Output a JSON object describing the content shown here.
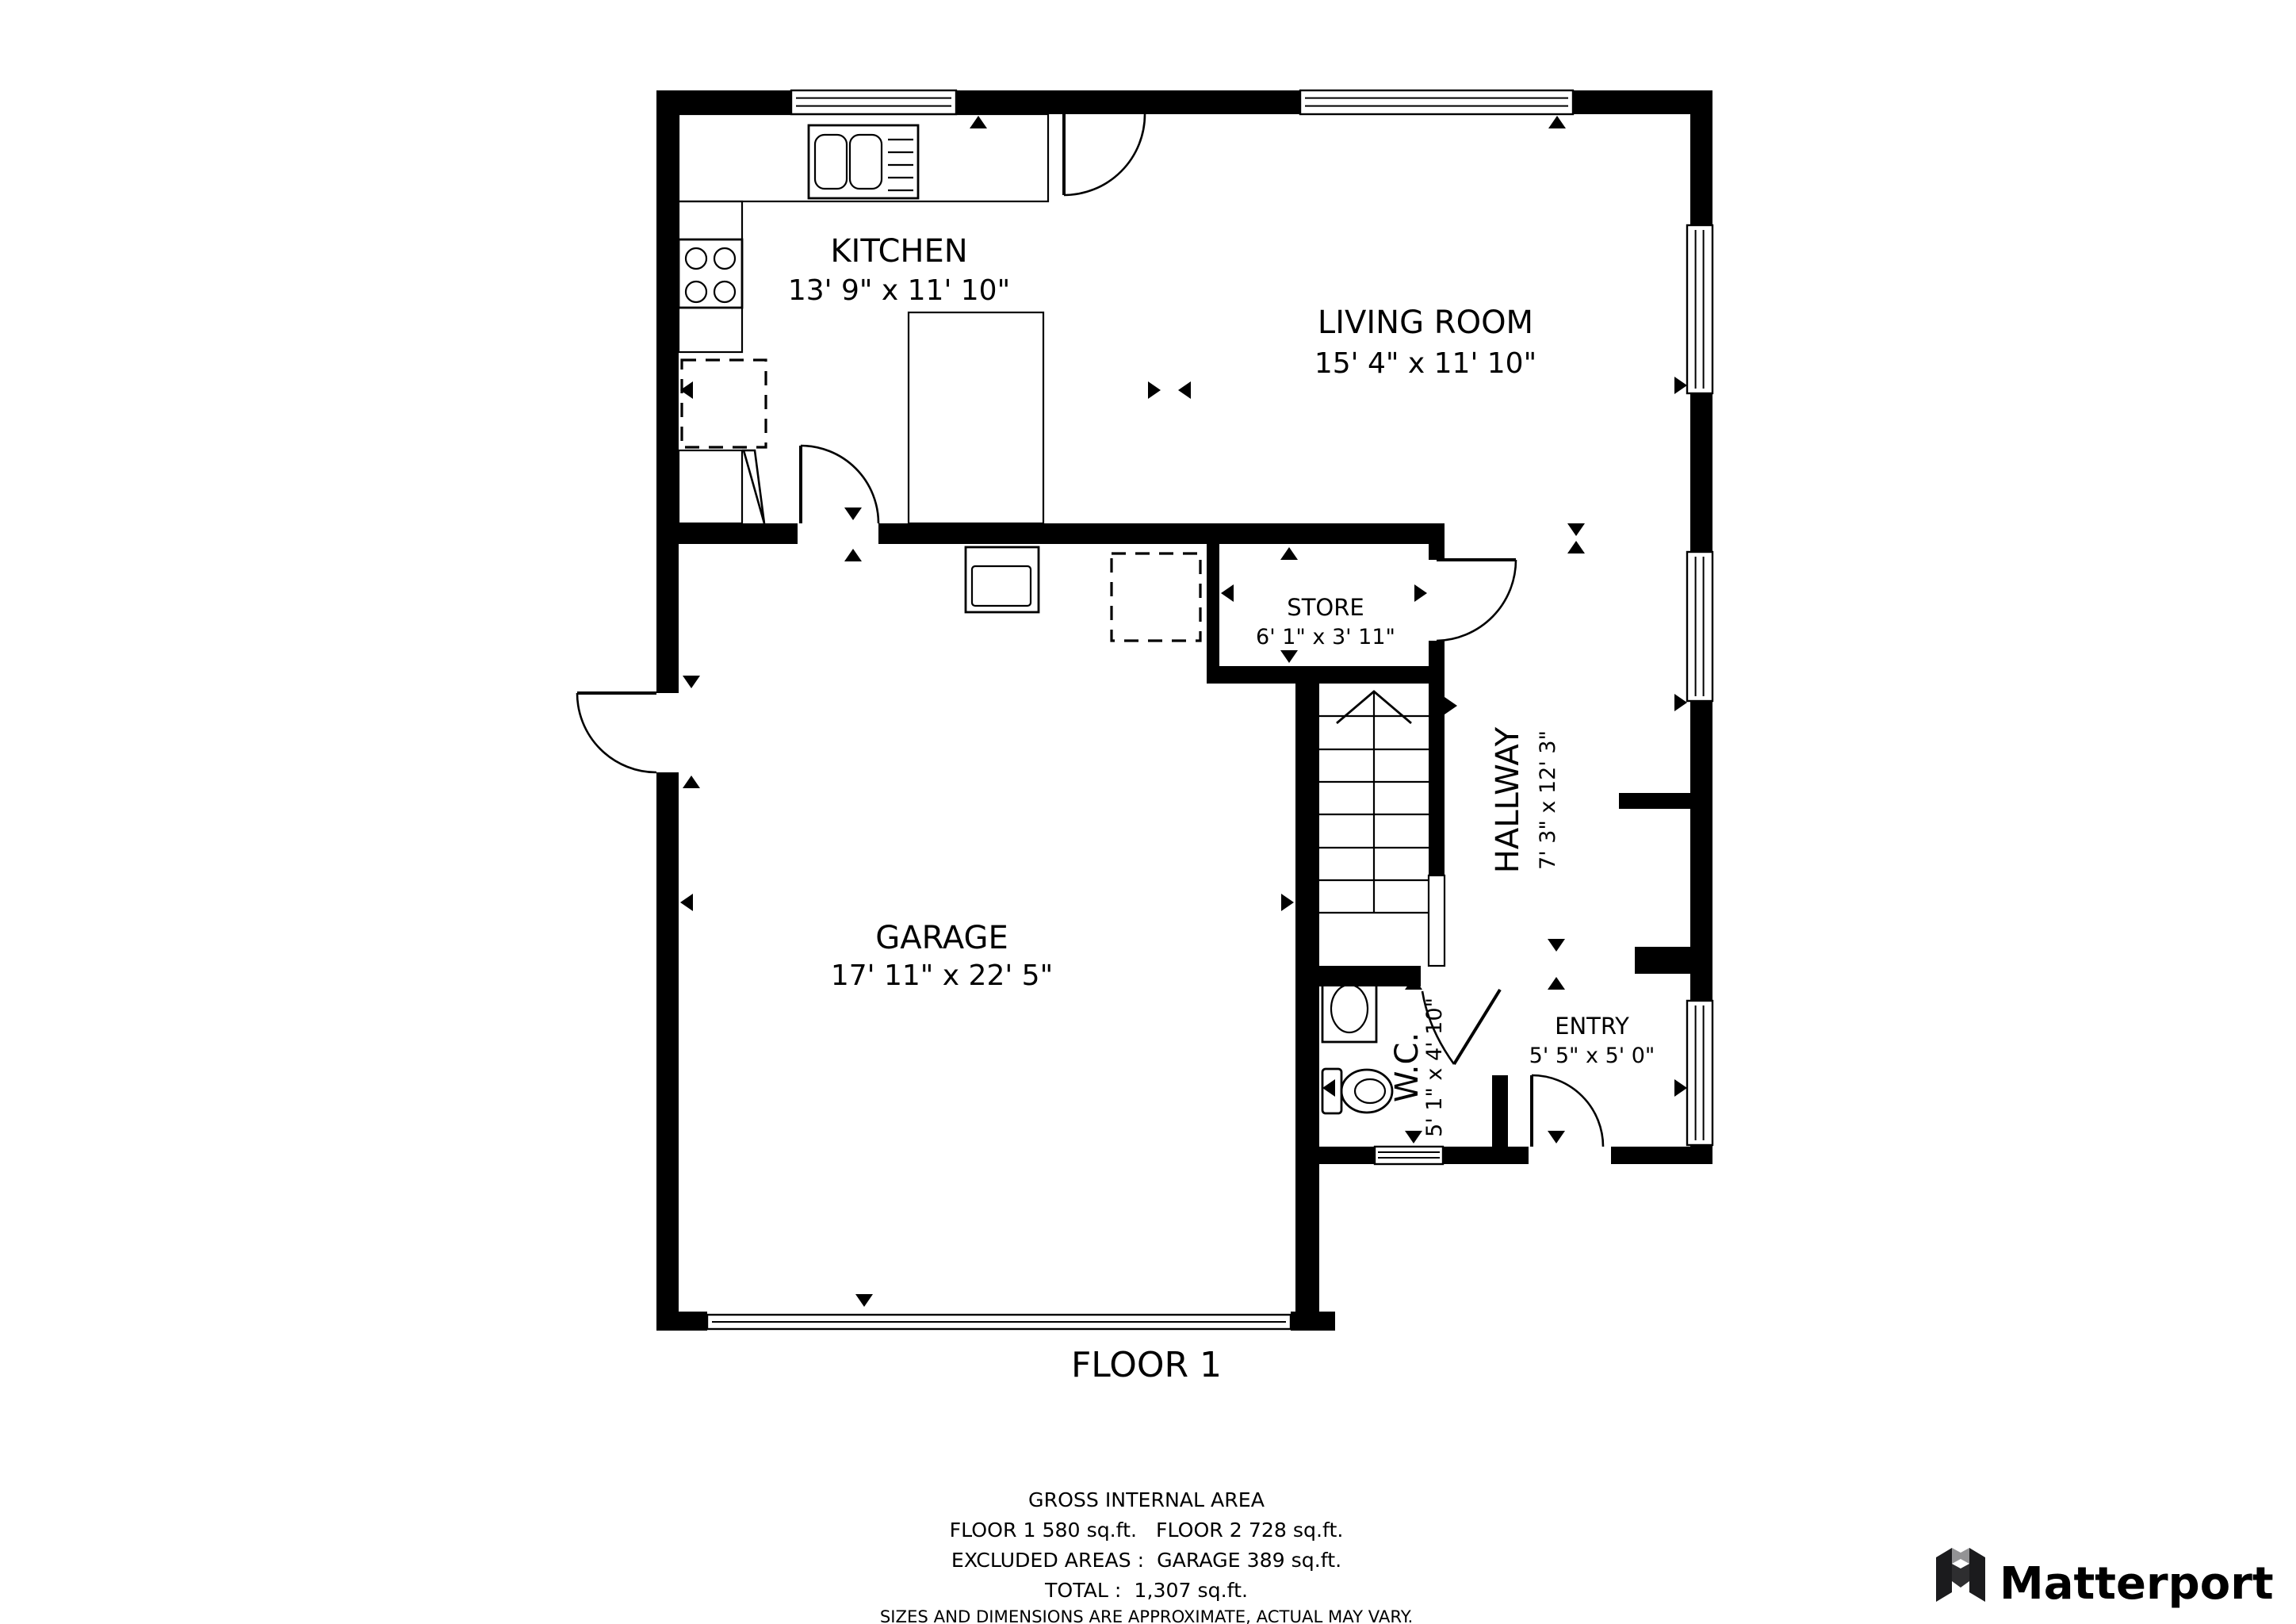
{
  "rooms": {
    "kitchen": {
      "name": "KITCHEN",
      "dims": "13' 9\" x 11' 10\""
    },
    "living_room": {
      "name": "LIVING ROOM",
      "dims": "15' 4\" x 11' 10\""
    },
    "store": {
      "name": "STORE",
      "dims": "6' 1\" x 3' 11\""
    },
    "hallway": {
      "name": "HALLWAY",
      "dims": "7' 3\" x 12' 3\""
    },
    "garage": {
      "name": "GARAGE",
      "dims": "17' 11\" x 22' 5\""
    },
    "wc": {
      "name": "W.C.",
      "dims": "5' 1\" x 4' 10\""
    },
    "entry": {
      "name": "ENTRY",
      "dims": "5' 5\" x 5' 0\""
    }
  },
  "floor_label": "FLOOR 1",
  "footer": {
    "title": "GROSS INTERNAL AREA",
    "line1": "FLOOR 1 580 sq.ft.   FLOOR 2 728 sq.ft.",
    "line2": "EXCLUDED AREAS :  GARAGE 389 sq.ft.",
    "line3": "TOTAL :  1,307 sq.ft.",
    "disclaimer": "SIZES AND DIMENSIONS ARE APPROXIMATE, ACTUAL MAY VARY."
  },
  "branding": {
    "logo_text": "Matterport"
  },
  "colors": {
    "wall": "#000000",
    "background": "#ffffff",
    "disclaimer_gray": "#7d7d7d",
    "logo_dark": "#3a3a3c",
    "logo_gray": "#939395",
    "logo_deep": "#2e2e30"
  }
}
